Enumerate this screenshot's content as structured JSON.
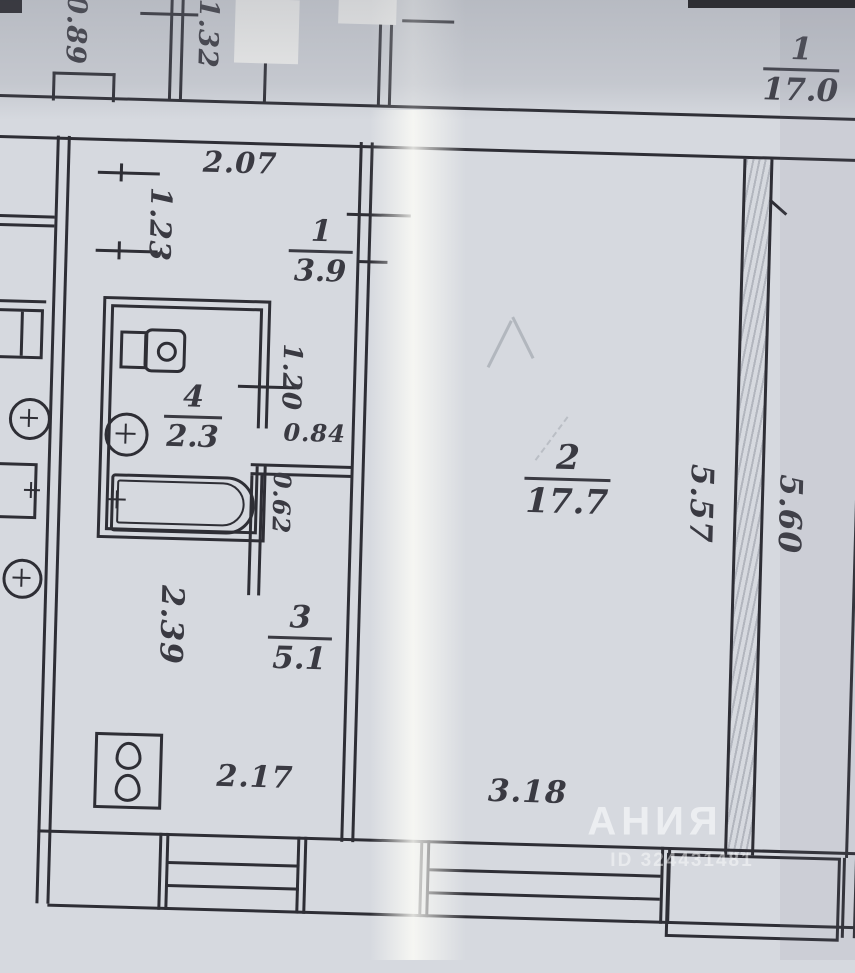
{
  "photo": {
    "watermark_text": "АНИЯ",
    "watermark_id": "ID 324431481"
  },
  "plan": {
    "rooms": {
      "neighbor": {
        "number": "1",
        "area": "17.0"
      },
      "hall": {
        "number": "1",
        "area": "3.9"
      },
      "bathroom": {
        "number": "4",
        "area": "2.3"
      },
      "kitchen": {
        "number": "3",
        "area": "5.1"
      },
      "living": {
        "number": "2",
        "area": "17.7"
      }
    },
    "dimensions": {
      "d_089": "0.89",
      "d_132": "1.32",
      "d_207": "2.07",
      "d_123": "1.23",
      "d_120": "1.20",
      "d_084": "0.84",
      "d_062": "0.62",
      "d_239": "2.39",
      "d_217": "2.17",
      "d_318": "3.18",
      "d_557": "5.57",
      "d_560": "5.60"
    },
    "colors": {
      "paper": "#d6d9df",
      "ink": "#2e2e35",
      "handwriting": "#3a3a42",
      "fold_highlight": "#fbfbf6"
    }
  }
}
